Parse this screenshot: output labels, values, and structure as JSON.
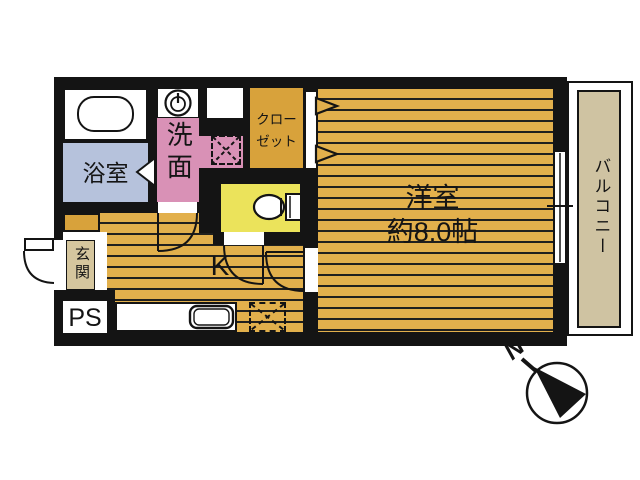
{
  "plan": {
    "type_note": "apartment floor plan",
    "rooms": {
      "bathroom": {
        "label": "浴室"
      },
      "washroom": {
        "label": "洗面"
      },
      "closet": {
        "label": "クローゼット",
        "label_line1": "クロー",
        "label_line2": "ゼット"
      },
      "western_room": {
        "label": "洋室",
        "size": "約8.0帖"
      },
      "kitchen": {
        "label": "K"
      },
      "entrance": {
        "label": "玄関"
      },
      "pipe_space": {
        "label": "PS"
      },
      "balcony": {
        "label": "バルコニー"
      }
    },
    "compass": {
      "label": "N"
    },
    "colors": {
      "wall": "#141414",
      "floor_orange": "#e2b04c",
      "closet_orange": "#d8a23b",
      "bath_blue": "#b6c2dc",
      "washroom_pink": "#d991b6",
      "toilet_yellow": "#ebe35b",
      "entrance_beige": "#d5c69e",
      "balcony_beige": "#cfc3a2"
    }
  }
}
